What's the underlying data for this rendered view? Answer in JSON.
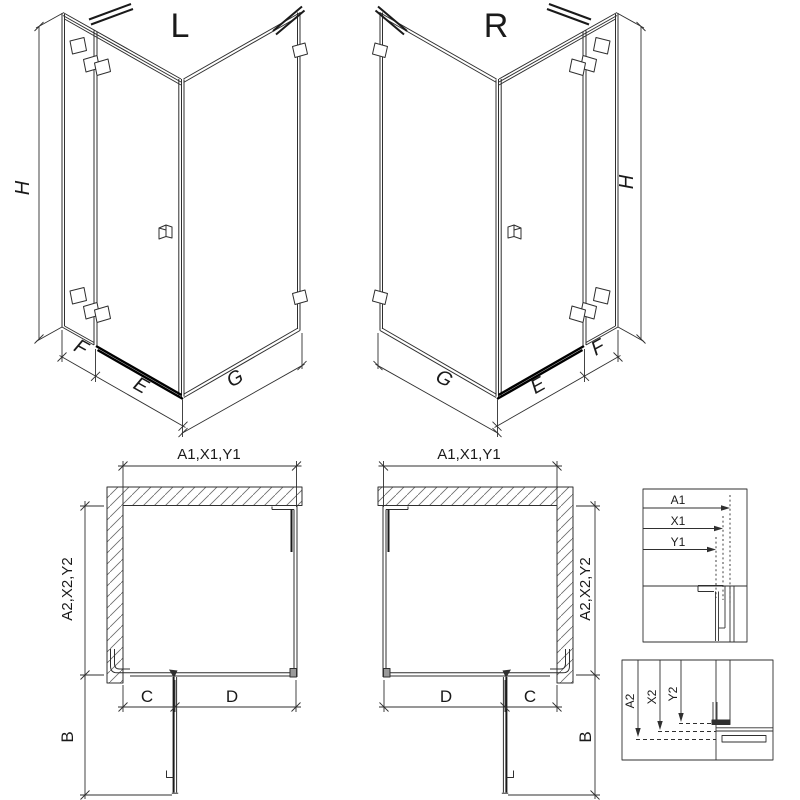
{
  "labels": {
    "iso_left": {
      "view": "L",
      "height": "H",
      "fixed": "F",
      "door": "E",
      "return_panel": "G"
    },
    "iso_right": {
      "view": "R",
      "height": "H",
      "fixed": "F",
      "door": "E",
      "return_panel": "G"
    },
    "plan_left": {
      "width": "A1,X1,Y1",
      "depth": "A2,X2,Y2",
      "c": "C",
      "d": "D",
      "b": "B"
    },
    "plan_right": {
      "width": "A1,X1,Y1",
      "depth": "A2,X2,Y2",
      "c": "C",
      "d": "D",
      "b": "B"
    },
    "detail_width": {
      "a1": "A1",
      "x1": "X1",
      "y1": "Y1"
    },
    "detail_depth": {
      "a2": "A2",
      "x2": "X2",
      "y2": "Y2"
    }
  },
  "colors": {
    "line": "#2f2f2f",
    "profile_bar": "#000000",
    "hatch": "#6b6b6b",
    "text": "#1a1a1a",
    "background": "#ffffff"
  }
}
